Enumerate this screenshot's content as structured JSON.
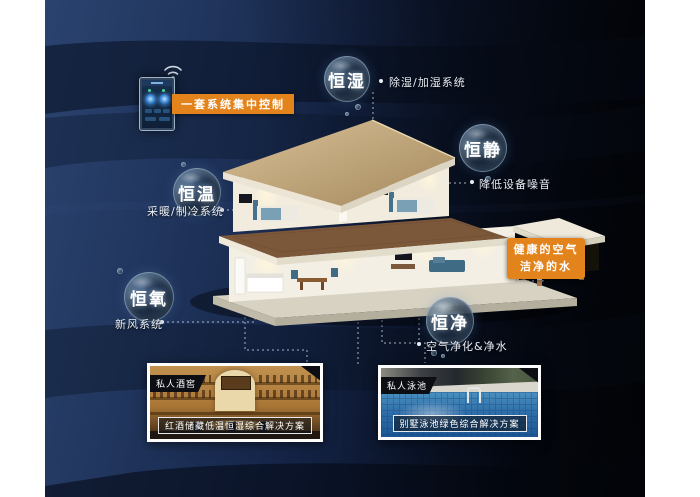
{
  "scene": {
    "accent_orange": "#e2831c",
    "bg_navy": "#21365e",
    "bg_black": "#03060c"
  },
  "control_panel": {
    "label": "一套系统集中控制"
  },
  "features": [
    {
      "name": "恒湿",
      "note": "除湿/加湿系统"
    },
    {
      "name": "恒静",
      "note": "降低设备噪音"
    },
    {
      "name": "恒温",
      "note": "采暖/制冷系统"
    },
    {
      "name": "恒氧",
      "note": "新风系统"
    },
    {
      "name": "恒净",
      "note": "空气净化&净水"
    }
  ],
  "highlight": {
    "line1": "健康的空气",
    "line2": "洁净的水"
  },
  "cases": [
    {
      "tag": "私人酒窖",
      "caption": "红酒储藏低温恒湿综合解决方案"
    },
    {
      "tag": "私人泳池",
      "caption": "别墅泳池绿色综合解决方案"
    }
  ]
}
